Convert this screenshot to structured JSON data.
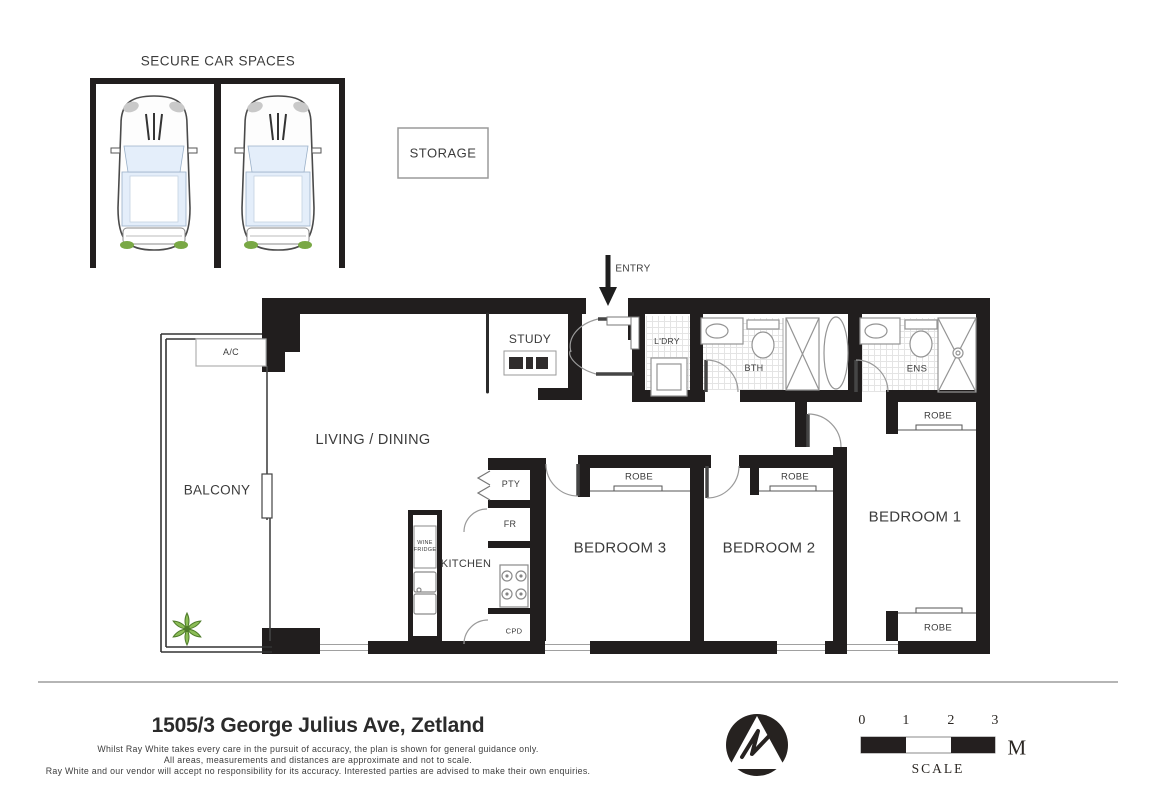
{
  "car_area": {
    "title": "SECURE CAR SPACES",
    "spaces": 2
  },
  "storage": {
    "label": "STORAGE"
  },
  "entry": {
    "label": "ENTRY"
  },
  "rooms": {
    "living_dining": "LIVING / DINING",
    "balcony": "BALCONY",
    "ac_unit": "A/C",
    "study": "STUDY",
    "laundry": "L'DRY",
    "bathroom": "BTH",
    "ensuite": "ENS",
    "kitchen": "KITCHEN",
    "pantry": "PTY",
    "fridge": "FR",
    "wine_fridge_line1": "WINE",
    "wine_fridge_line2": "FRIDGE",
    "cupboard": "CPD",
    "bedroom1": "BEDROOM 1",
    "bedroom2": "BEDROOM 2",
    "bedroom3": "BEDROOM 3",
    "robe": "ROBE"
  },
  "footer": {
    "address": "1505/3 George Julius Ave, Zetland",
    "disclaimer": [
      "Whilst Ray White takes every care in the pursuit of accuracy, the plan is shown for general guidance only.",
      "All areas, measurements and distances are approximate and not to scale.",
      "Ray White and our vendor will accept no responsibility for its accuracy. Interested parties are advised to make their own enquiries."
    ]
  },
  "compass": {
    "letter": "N"
  },
  "scale_bar": {
    "ticks": [
      "0",
      "1",
      "2",
      "3"
    ],
    "unit": "M",
    "label": "SCALE"
  },
  "colors": {
    "wall": "#211e1e",
    "label_text": "#3b3b3b",
    "plant_green": "#8cbd57",
    "car_glass": "#e4eefa"
  }
}
